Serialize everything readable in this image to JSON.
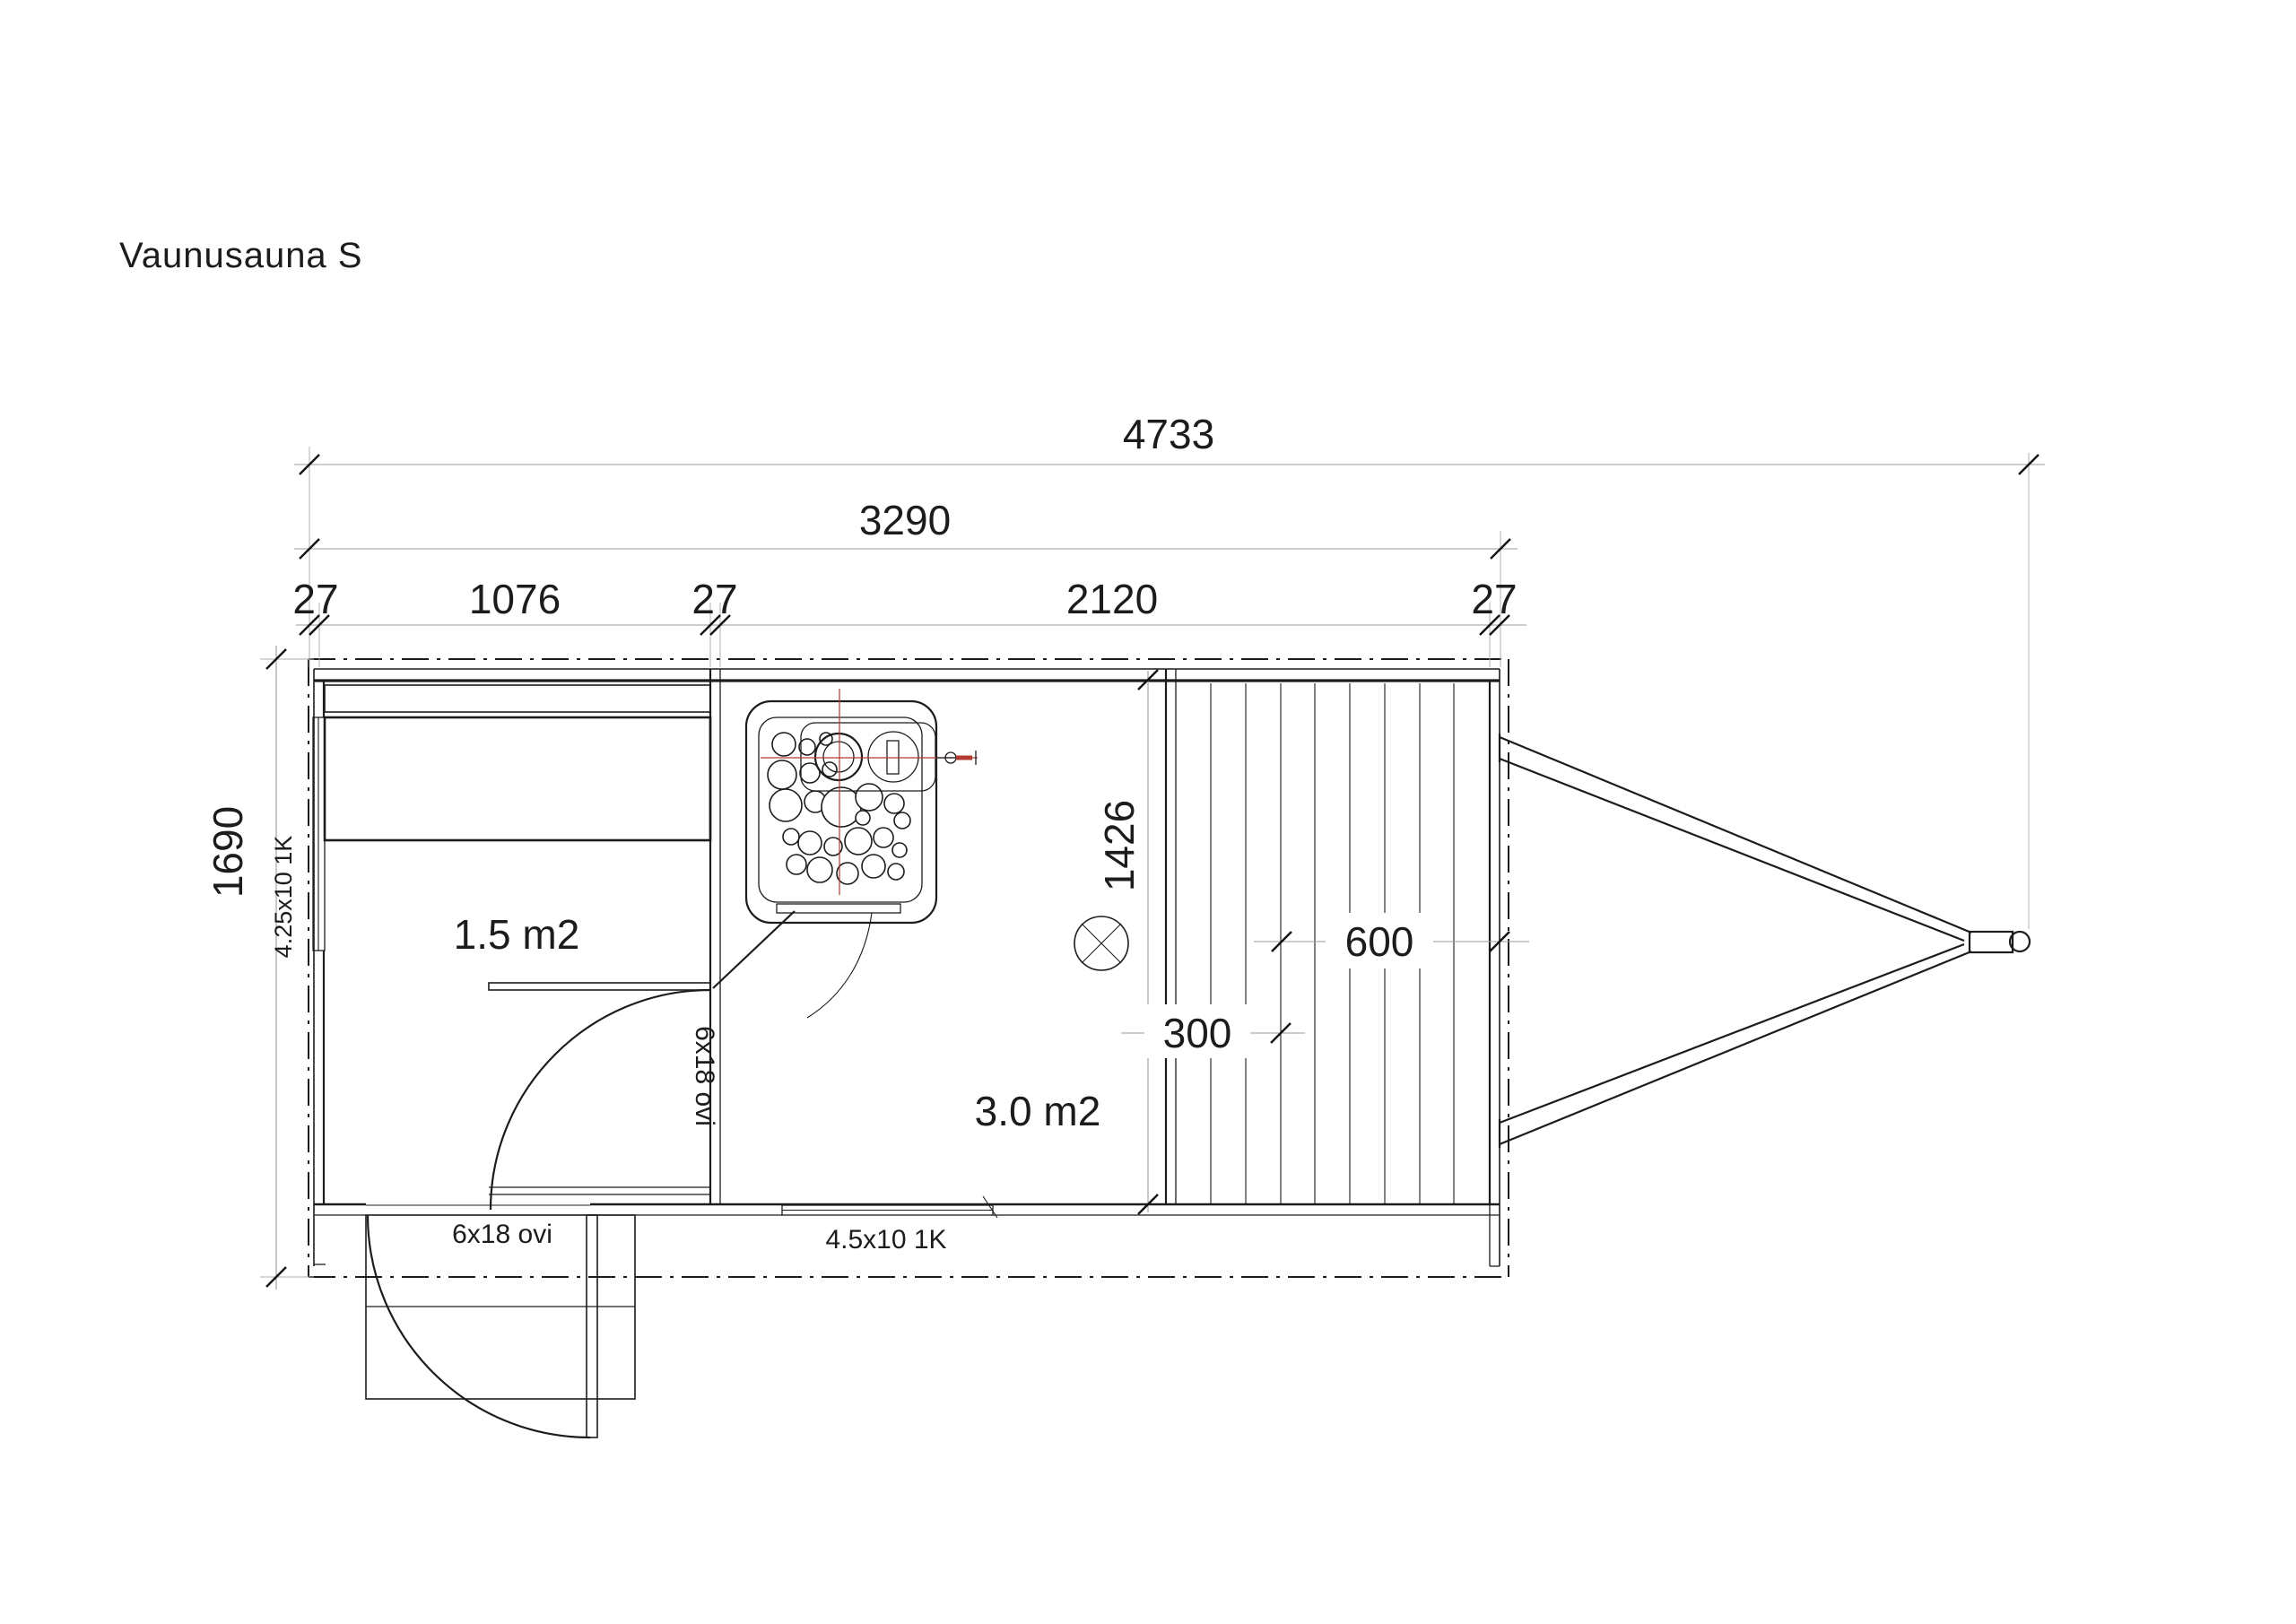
{
  "labels": {
    "title": "Vaunusauna S",
    "dim_overall": "4733",
    "dim_body": "3290",
    "dim_wall_a": "27",
    "dim_room1": "1076",
    "dim_wall_b": "27",
    "dim_room2": "2120",
    "dim_wall_c": "27",
    "dim_height": "1690",
    "dim_sauna_depth": "1426",
    "dim_deck_600": "600",
    "dim_deck_300": "300",
    "room_dressing_area": "1.5 m2",
    "room_sauna_area": "3.0 m2",
    "door_interior": "6x18 ovi",
    "door_entrance": "6x18 ovi",
    "window_left": "4.25x10 1K",
    "window_bottom": "4.5x10 1K"
  },
  "colors": {
    "line": "#1c1c1c",
    "dimension_line": "#9b9b9b",
    "centerline_red": "#b23a32",
    "background": "#ffffff"
  }
}
